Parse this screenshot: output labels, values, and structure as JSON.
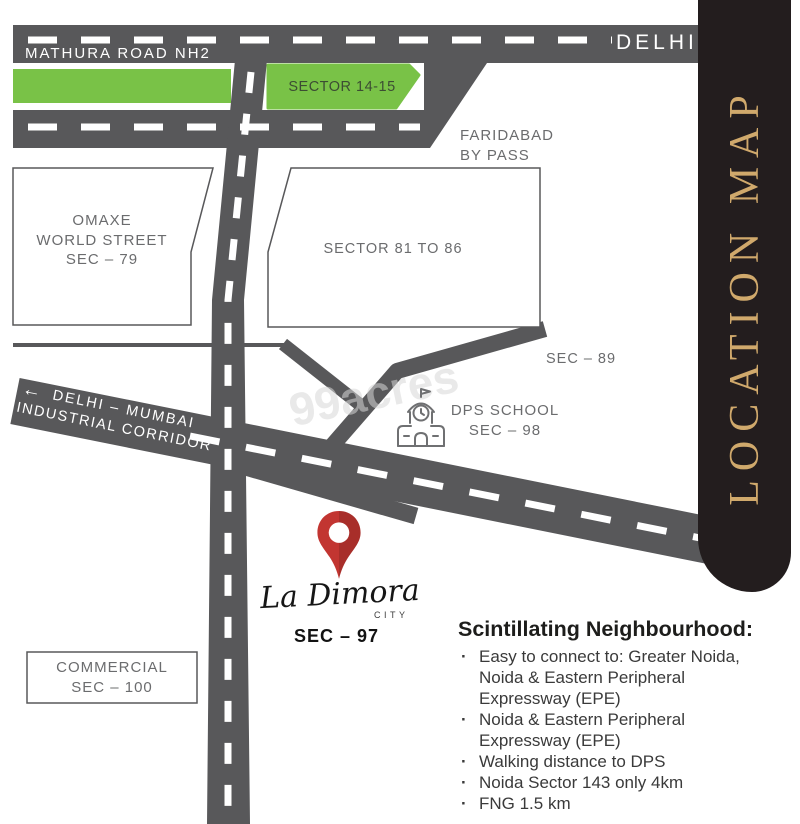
{
  "panel": {
    "title": "LOCATION MAP"
  },
  "roads": {
    "mathura_label": "MATHURA ROAD NH2",
    "delhi_label": "DELHI",
    "corridor_arrow": "←",
    "corridor_line1": "DELHI – MUMBAI",
    "corridor_line2": "INDUSTRIAL CORRIDOR"
  },
  "areas": {
    "sector_14_15": "SECTOR 14-15",
    "faridabad_line1": "FARIDABAD",
    "faridabad_line2": "BY PASS",
    "omaxe_line1": "OMAXE",
    "omaxe_line2": "WORLD STREET",
    "omaxe_line3": "SEC – 79",
    "sector_81_86": "SECTOR 81 TO 86",
    "sec_89": "SEC – 89",
    "dps_line1": "DPS SCHOOL",
    "dps_line2": "SEC – 98",
    "commercial_line1": "COMMERCIAL",
    "commercial_line2": "SEC – 100"
  },
  "project": {
    "name": "La Dimora",
    "tagline": "CITY",
    "sector": "SEC – 97"
  },
  "neighbourhood": {
    "heading": "Scintillating Neighbourhood:",
    "bullets": [
      "Easy to connect to: Greater Noida, Noida & Eastern Peripheral Expressway (EPE)",
      "Noida & Eastern Peripheral Expressway (EPE)",
      "Walking distance to DPS",
      "Noida Sector 143 only 4km",
      "FNG 1.5 km"
    ]
  },
  "watermark": "99acres",
  "colors": {
    "road": "#58585a",
    "green": "#79c247",
    "panel_bg": "#231d1e",
    "gold": "#d0a96c",
    "pin_red": "#c23531",
    "label_gray": "#6b6c6e"
  }
}
